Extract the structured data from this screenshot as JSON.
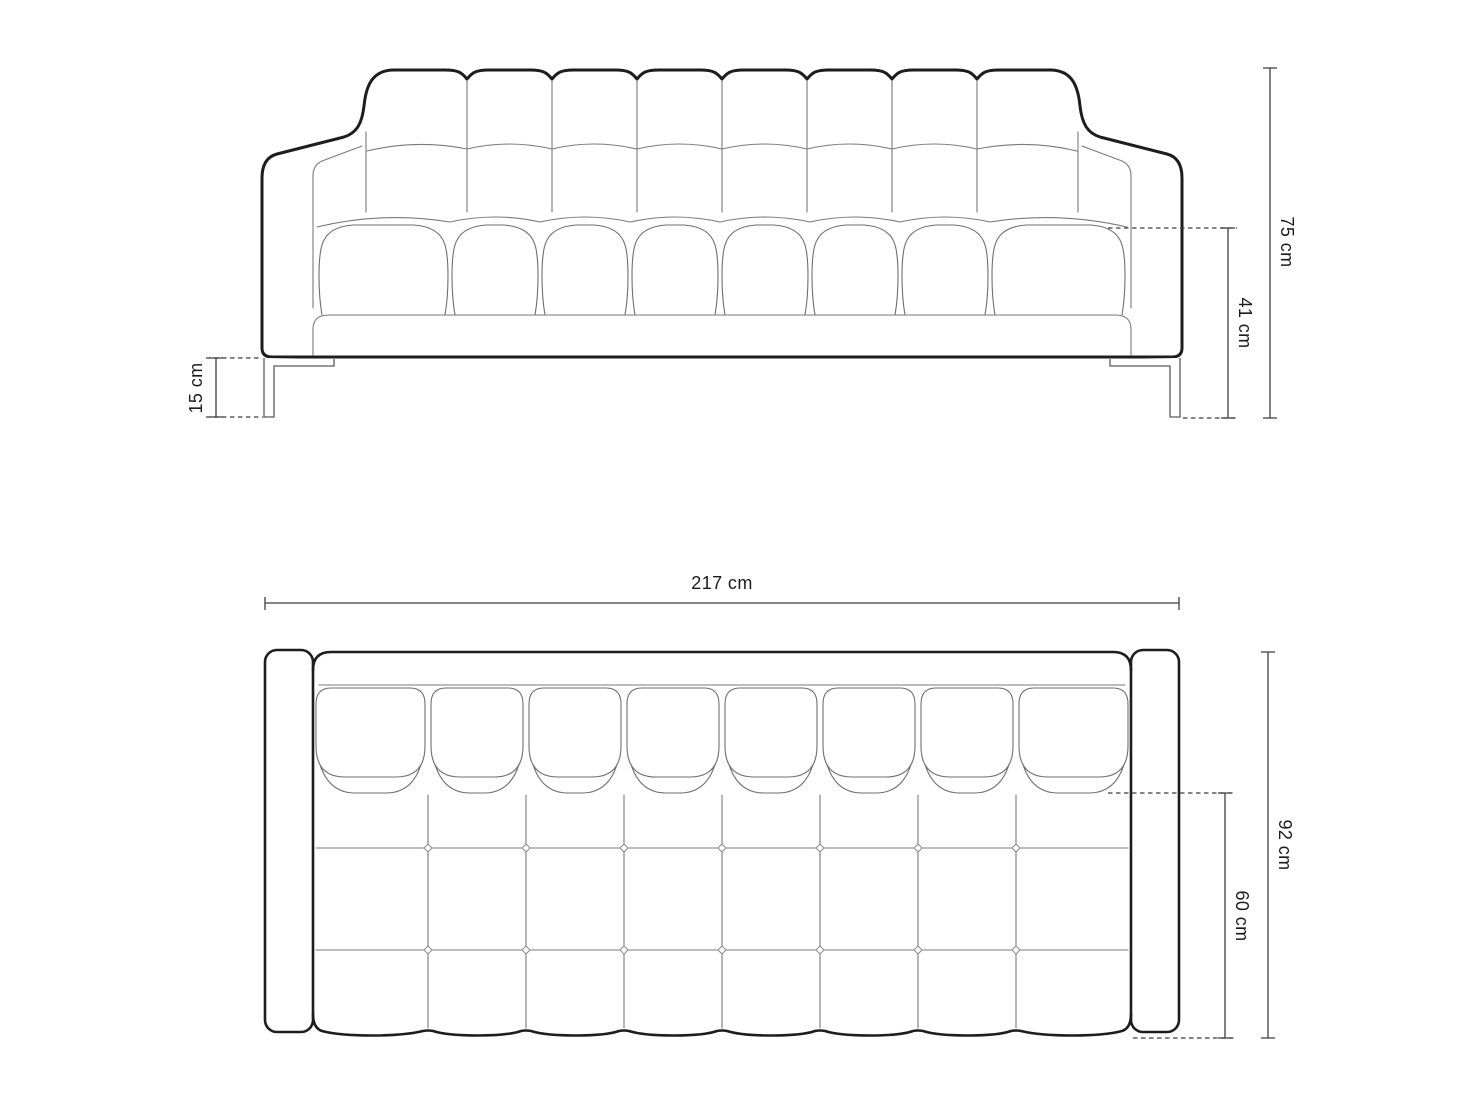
{
  "front_view": {
    "total_height_label": "75 cm",
    "seat_height_label": "41 cm",
    "leg_height_label": "15 cm"
  },
  "top_view": {
    "total_width_label": "217 cm",
    "total_depth_label": "92 cm",
    "seat_depth_label": "60 cm"
  },
  "colors": {
    "outline": "#1d1d1d",
    "detail_line": "#7a7a7a",
    "dimension_line": "#3f3f3f",
    "label_text": "#1b1b1b",
    "background": "#ffffff"
  }
}
